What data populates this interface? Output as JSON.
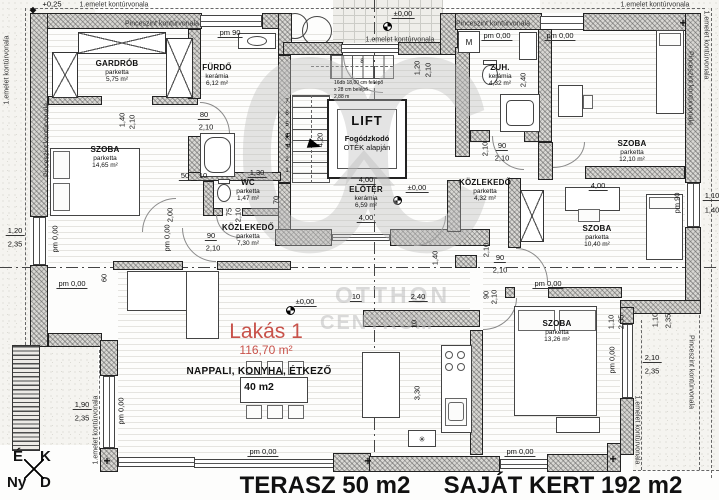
{
  "plan": {
    "apartment": {
      "name": "Lakás 1",
      "area": "116,70 m²"
    },
    "living_label": {
      "name": "NAPPALI, KONYHA, ÉTKEZŐ",
      "area": "40 m2"
    },
    "bottom": {
      "terrace": "TERASZ 50 m2",
      "garden": "SAJÁT KERT 192 m2"
    },
    "compass": {
      "north": "É",
      "east": "K",
      "west": "Ny",
      "south": "D"
    },
    "watermark": {
      "logo": "OC",
      "line1": "OTTHON",
      "line2": "CENTRUM"
    },
    "lift": {
      "title": "LIFT",
      "note_bold": "Fogódzkodó",
      "note": "OTÉK alapján"
    },
    "stairs": {
      "line1": "16db 18,00 cm fellépő",
      "line2": "x 28 cm belépő",
      "line3": "2,88 m",
      "numbers": [
        "1",
        "2",
        "3",
        "4",
        "5",
        "6",
        "7"
      ],
      "upper_number": "8"
    },
    "appliances": {
      "washer": "M",
      "star": "✳"
    },
    "colors": {
      "accent_red": "#c8524a",
      "watermark_gray": "#bdbdbd",
      "wall_gray": "#d8d7d3"
    },
    "rooms": [
      {
        "name": "GARDRÓB",
        "floor": "parketta",
        "area": "5,75 m²",
        "x": 117,
        "y": 60
      },
      {
        "name": "FÜRDŐ",
        "floor": "kerámia",
        "area": "6,12 m²",
        "x": 217,
        "y": 64
      },
      {
        "name": "SZOBA",
        "floor": "parketta",
        "area": "14,65 m²",
        "x": 105,
        "y": 146
      },
      {
        "name": "WC",
        "floor": "parketta",
        "area": "1,47 m²",
        "x": 248,
        "y": 179
      },
      {
        "name": "KÖZLEKEDŐ",
        "floor": "parketta",
        "area": "7,30 m²",
        "x": 248,
        "y": 224
      },
      {
        "name": "ELŐTÉR",
        "floor": "kerámia",
        "area": "6,59 m²",
        "x": 366,
        "y": 186
      },
      {
        "name": "ZUH.",
        "floor": "kerámia",
        "area": "4,32 m²",
        "x": 500,
        "y": 64
      },
      {
        "name": "SZOBA",
        "floor": "parketta",
        "area": "12,10 m²",
        "x": 632,
        "y": 140
      },
      {
        "name": "KÖZLEKEDŐ",
        "floor": "parketta",
        "area": "4,32 m²",
        "x": 485,
        "y": 179
      },
      {
        "name": "SZOBA",
        "floor": "parketta",
        "area": "10,40 m²",
        "x": 597,
        "y": 225
      },
      {
        "name": "SZOBA",
        "floor": "parketta",
        "area": "13,26 m²",
        "x": 557,
        "y": 320
      }
    ],
    "contour_labels": [
      {
        "text": "1.emelet kontúrvonala",
        "x": 114,
        "y": 5
      },
      {
        "text": "Pinceszint kontúrvonala",
        "x": 162,
        "y": 24
      },
      {
        "text": "1.emelet kontúrvonala",
        "x": 400,
        "y": 40
      },
      {
        "text": "Pinceszint kontúrvonala",
        "x": 493,
        "y": 24
      },
      {
        "text": "1.emelet kontúrvonala",
        "x": 655,
        "y": 5
      },
      {
        "text": "1.emelet kontúrvonala",
        "x": 7,
        "y": 70,
        "r": -90
      },
      {
        "text": "Pinceszint kontúrvonala",
        "x": 47,
        "y": 140,
        "r": -90
      },
      {
        "text": "1.emelet kontúrvonala",
        "x": 96,
        "y": 430,
        "r": -90
      },
      {
        "text": "1.emelet kontúrvonala",
        "x": 706,
        "y": 45,
        "r": 90
      },
      {
        "text": "Pinceszint kontúrvonala",
        "x": 690,
        "y": 88,
        "r": 90
      },
      {
        "text": "Pinceszint kontúrvonala",
        "x": 691,
        "y": 372,
        "r": 90
      },
      {
        "text": "1.emelet kontúrvonala",
        "x": 637,
        "y": 430,
        "r": 90
      }
    ],
    "dimensions": [
      {
        "t": "+0,25",
        "x": 52,
        "y": 4
      },
      {
        "t": "pm 90",
        "x": 230,
        "y": 33,
        "u": 1
      },
      {
        "t": "±0,00",
        "x": 403,
        "y": 14,
        "u": 1
      },
      {
        "t": "pm 0,00",
        "x": 497,
        "y": 36,
        "u": 1
      },
      {
        "t": "pm 0,00",
        "x": 560,
        "y": 36,
        "u": 1
      },
      {
        "t": "80",
        "x": 204,
        "y": 115,
        "u": 1
      },
      {
        "t": "2,10",
        "x": 206,
        "y": 127
      },
      {
        "t": "1,40",
        "x": 122,
        "y": 120,
        "r": -90
      },
      {
        "t": "2,10",
        "x": 132,
        "y": 122,
        "r": -90
      },
      {
        "t": "1,20",
        "x": 417,
        "y": 68,
        "r": -90
      },
      {
        "t": "2,10",
        "x": 428,
        "y": 70,
        "r": -90
      },
      {
        "t": "4,20",
        "x": 288,
        "y": 140,
        "r": -90
      },
      {
        "t": "4,20",
        "x": 320,
        "y": 140,
        "r": -90
      },
      {
        "t": "2,40",
        "x": 523,
        "y": 80,
        "r": -90
      },
      {
        "t": "90",
        "x": 502,
        "y": 146,
        "u": 1
      },
      {
        "t": "2,10",
        "x": 502,
        "y": 158
      },
      {
        "t": "2,10",
        "x": 485,
        "y": 149,
        "r": -90
      },
      {
        "t": "4,00",
        "x": 366,
        "y": 180,
        "u": 1
      },
      {
        "t": "±0,00",
        "x": 417,
        "y": 188,
        "u": 1
      },
      {
        "t": "4,00",
        "x": 366,
        "y": 218,
        "u": 1
      },
      {
        "t": "4,00",
        "x": 598,
        "y": 186,
        "u": 1
      },
      {
        "t": "2,00",
        "x": 170,
        "y": 215,
        "r": -90
      },
      {
        "t": "75",
        "x": 229,
        "y": 212,
        "r": -90
      },
      {
        "t": "2,10",
        "x": 238,
        "y": 215,
        "r": -90
      },
      {
        "t": "70",
        "x": 276,
        "y": 200,
        "r": -90
      },
      {
        "t": "50",
        "x": 185,
        "y": 176,
        "u": 1
      },
      {
        "t": "10",
        "x": 203,
        "y": 176,
        "u": 1
      },
      {
        "t": "1,30",
        "x": 257,
        "y": 173,
        "u": 1
      },
      {
        "t": "90",
        "x": 211,
        "y": 236,
        "u": 1
      },
      {
        "t": "2,10",
        "x": 213,
        "y": 248
      },
      {
        "t": "1,20",
        "x": 15,
        "y": 231,
        "u": 1
      },
      {
        "t": "2,35",
        "x": 15,
        "y": 244
      },
      {
        "t": "pm 0,00",
        "x": 55,
        "y": 239,
        "r": -90
      },
      {
        "t": "pm 0,00",
        "x": 167,
        "y": 238,
        "r": -90
      },
      {
        "t": "pm 0,00",
        "x": 72,
        "y": 284,
        "u": 1
      },
      {
        "t": "60",
        "x": 104,
        "y": 278,
        "r": -90
      },
      {
        "t": "1,40",
        "x": 435,
        "y": 258,
        "r": -90
      },
      {
        "t": "10",
        "x": 356,
        "y": 297,
        "u": 1
      },
      {
        "t": "2,40",
        "x": 418,
        "y": 297,
        "u": 1
      },
      {
        "t": "±0,00",
        "x": 305,
        "y": 302,
        "u": 1
      },
      {
        "t": "10",
        "x": 414,
        "y": 324,
        "r": -90
      },
      {
        "t": "90",
        "x": 500,
        "y": 258,
        "u": 1
      },
      {
        "t": "2,10",
        "x": 500,
        "y": 270
      },
      {
        "t": "2,10",
        "x": 486,
        "y": 250,
        "r": -90
      },
      {
        "t": "90",
        "x": 486,
        "y": 295,
        "r": -90
      },
      {
        "t": "2,10",
        "x": 494,
        "y": 297,
        "r": -90
      },
      {
        "t": "pm 0,00",
        "x": 548,
        "y": 284,
        "u": 1
      },
      {
        "t": "pm 90",
        "x": 677,
        "y": 203,
        "r": -90
      },
      {
        "t": "1,10",
        "x": 712,
        "y": 196,
        "u": 1
      },
      {
        "t": "1,40",
        "x": 712,
        "y": 210
      },
      {
        "t": "1,10",
        "x": 611,
        "y": 322,
        "r": -90
      },
      {
        "t": "2,35",
        "x": 621,
        "y": 322,
        "r": -90
      },
      {
        "t": "1,10",
        "x": 655,
        "y": 320,
        "r": -90
      },
      {
        "t": "2,35",
        "x": 668,
        "y": 321,
        "r": -90
      },
      {
        "t": "2,10",
        "x": 652,
        "y": 358,
        "u": 1
      },
      {
        "t": "2,35",
        "x": 652,
        "y": 371
      },
      {
        "t": "pm 0,00",
        "x": 612,
        "y": 360,
        "r": -90
      },
      {
        "t": "3,30",
        "x": 417,
        "y": 393,
        "r": -90
      },
      {
        "t": "1,90",
        "x": 82,
        "y": 405,
        "u": 1
      },
      {
        "t": "2,35",
        "x": 82,
        "y": 418
      },
      {
        "t": "pm 0,00",
        "x": 121,
        "y": 411,
        "r": -90
      },
      {
        "t": "pm 0,00",
        "x": 263,
        "y": 452,
        "u": 1
      },
      {
        "t": "pm 0,00",
        "x": 520,
        "y": 452,
        "u": 1
      }
    ]
  }
}
